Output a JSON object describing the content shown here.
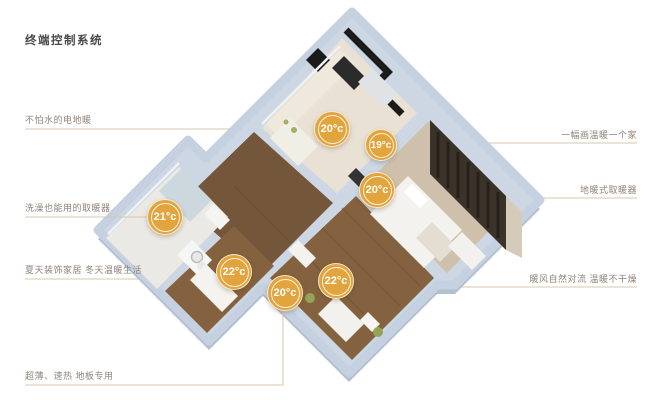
{
  "title": "终端控制系统",
  "annotations": {
    "left": [
      "不怕水的电地暖",
      "洗澡也能用的取暖器",
      "夏天装饰家居  冬天温暖生活",
      "超薄、速热 地板专用"
    ],
    "right": [
      "一幅画温暖一个家",
      "地暖式取暖器",
      "暖风自然对流  温暖不干燥"
    ]
  },
  "badges": [
    {
      "temp": "20°c"
    },
    {
      "temp": "19°c"
    },
    {
      "temp": "20°c"
    },
    {
      "temp": "21°c"
    },
    {
      "temp": "22°c"
    },
    {
      "temp": "20°c"
    },
    {
      "temp": "22°c"
    }
  ],
  "colors": {
    "badge": "#E2A43C",
    "leader_line": "#D8C7AB",
    "label_text": "#8E8379",
    "title_text": "#4A4A4A",
    "wall": "#CDD7E3"
  }
}
